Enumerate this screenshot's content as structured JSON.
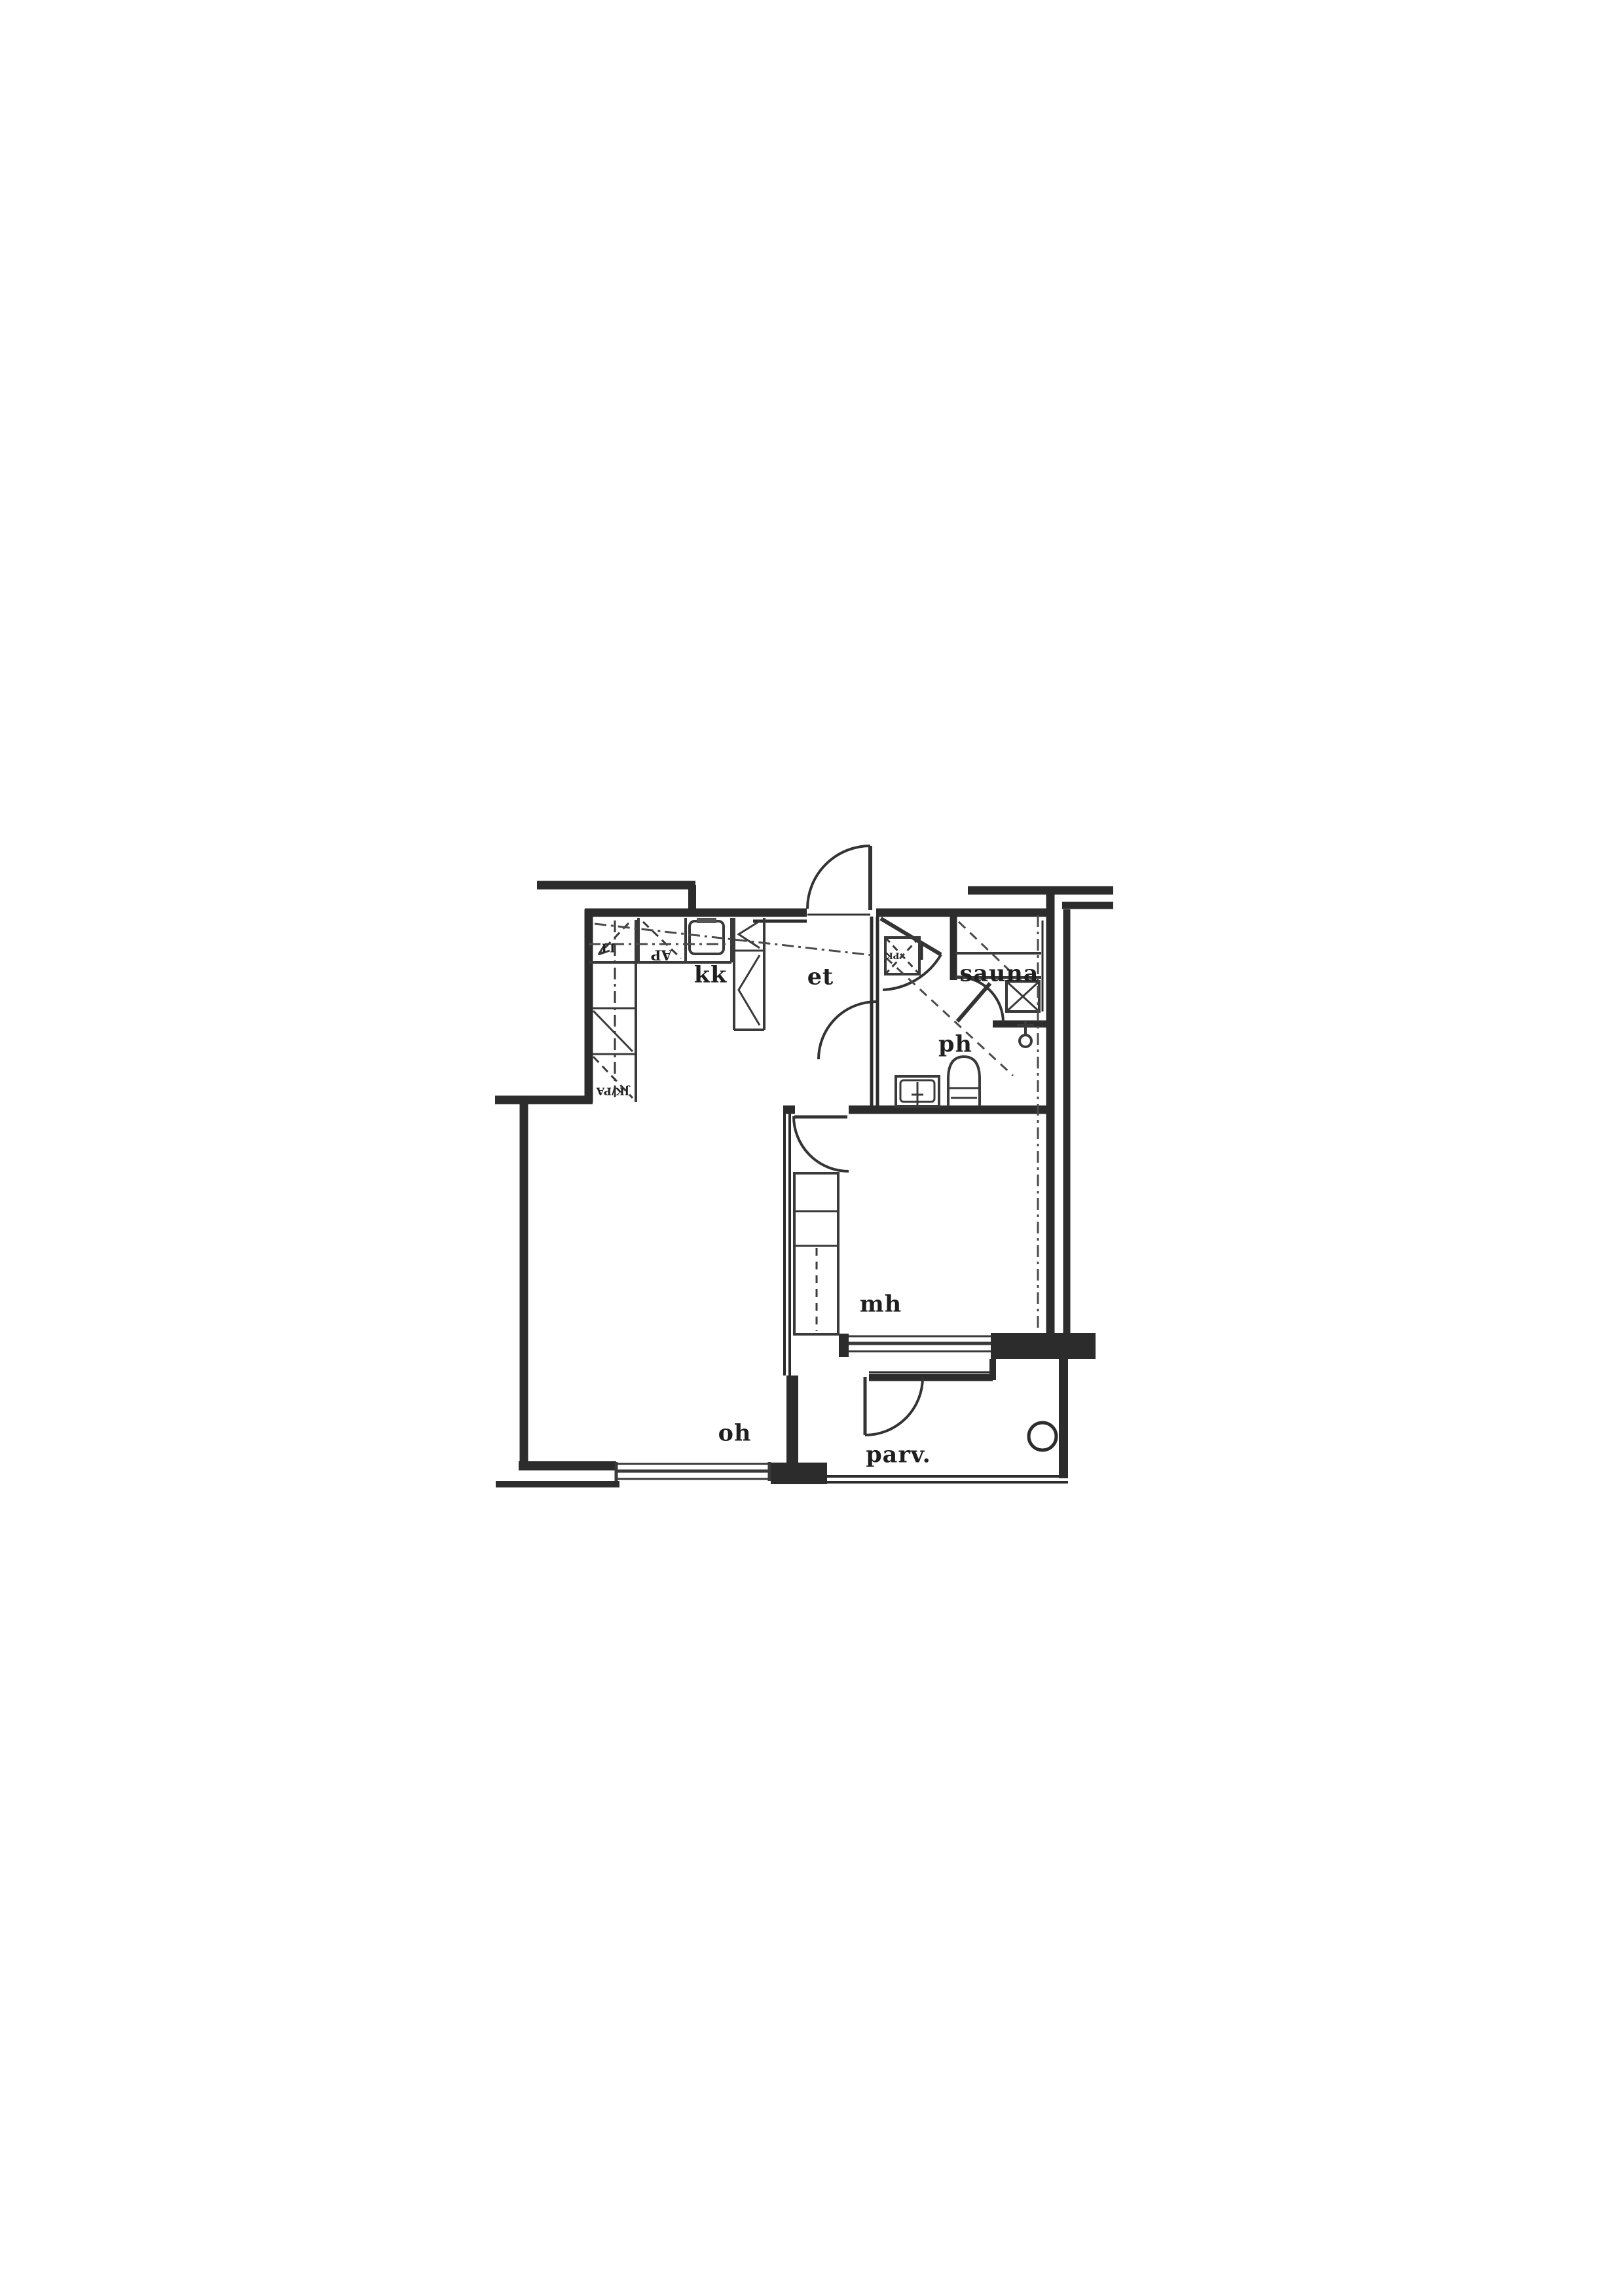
{
  "page": {
    "paper_color": "#ffffff",
    "ink_color": "#2c2c2c"
  },
  "rooms": [
    {
      "id": "kk",
      "label": "kk"
    },
    {
      "id": "et",
      "label": "et"
    },
    {
      "id": "sauna",
      "label": "sauna"
    },
    {
      "id": "ph",
      "label": "ph"
    },
    {
      "id": "mh",
      "label": "mh"
    },
    {
      "id": "oh",
      "label": "oh"
    },
    {
      "id": "parv",
      "label": "parv."
    }
  ],
  "appliance_labels": [
    {
      "id": "stove",
      "label": "LI"
    },
    {
      "id": "dishwasher",
      "label": "AP"
    },
    {
      "id": "fridge-freezer",
      "label": "JK/PA"
    },
    {
      "id": "washing-machine",
      "label": "PK"
    }
  ],
  "fixture_icons": [
    {
      "id": "kitchen-sink-icon"
    },
    {
      "id": "washbasin-icon"
    },
    {
      "id": "toilet-icon"
    },
    {
      "id": "shower-icon"
    },
    {
      "id": "sauna-stove-icon"
    },
    {
      "id": "sauna-bench-icon"
    },
    {
      "id": "washing-machine-reservation-icon"
    },
    {
      "id": "wardrobe-icon"
    },
    {
      "id": "balcony-circle-icon"
    },
    {
      "id": "door-swing-icon"
    },
    {
      "id": "window-icon"
    }
  ]
}
